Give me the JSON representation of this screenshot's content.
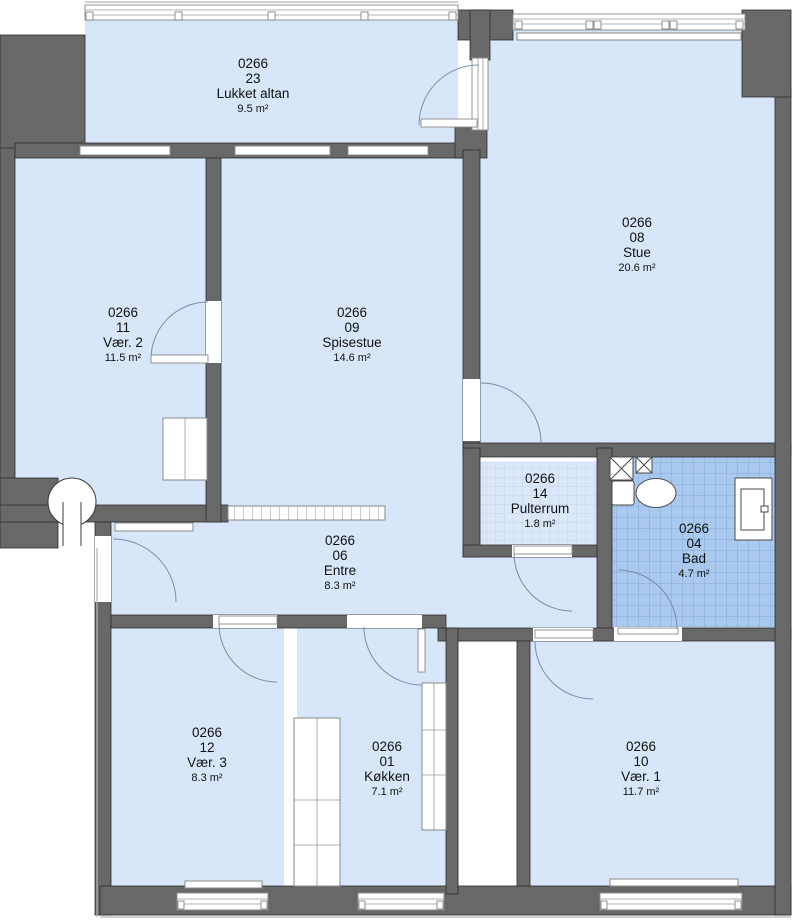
{
  "plan": {
    "type": "apartment-floor-plan",
    "unit_prefix": "0266",
    "colors": {
      "floor": "#d7e6f9",
      "wall": "#686868",
      "wall_outline": "#2e2e2e",
      "bath_tile": "#aac9ee",
      "bath_grid": "#84a9d6",
      "storage_grid": "#c4d4eb",
      "door_arc": "#7a8fa6"
    }
  },
  "rooms": [
    {
      "key": "lukket-altan",
      "id": "0266",
      "number": "23",
      "name": "Lukket altan",
      "area": "9.5 m²"
    },
    {
      "key": "vaer-2",
      "id": "0266",
      "number": "11",
      "name": "Vær. 2",
      "area": "11.5 m²"
    },
    {
      "key": "spisestue",
      "id": "0266",
      "number": "09",
      "name": "Spisestue",
      "area": "14.6 m²"
    },
    {
      "key": "stue",
      "id": "0266",
      "number": "08",
      "name": "Stue",
      "area": "20.6 m²"
    },
    {
      "key": "pulterrum",
      "id": "0266",
      "number": "14",
      "name": "Pulterrum",
      "area": "1.8 m²"
    },
    {
      "key": "bad",
      "id": "0266",
      "number": "04",
      "name": "Bad",
      "area": "4.7 m²"
    },
    {
      "key": "entre",
      "id": "0266",
      "number": "06",
      "name": "Entre",
      "area": "8.3 m²"
    },
    {
      "key": "vaer-3",
      "id": "0266",
      "number": "12",
      "name": "Vær. 3",
      "area": "8.3 m²"
    },
    {
      "key": "koekken",
      "id": "0266",
      "number": "01",
      "name": "Køkken",
      "area": "7.1 m²"
    },
    {
      "key": "vaer-1",
      "id": "0266",
      "number": "10",
      "name": "Vær. 1",
      "area": "11.7 m²"
    }
  ],
  "fixtures": {
    "toilet": "toilet-icon",
    "sink": "sink-vanity-icon",
    "shafts": "x-shaft-icon",
    "column": "column-icon",
    "wardrobe": "wardrobe-hatch",
    "radiator": "radiator",
    "counter": "kitchen-counter"
  }
}
